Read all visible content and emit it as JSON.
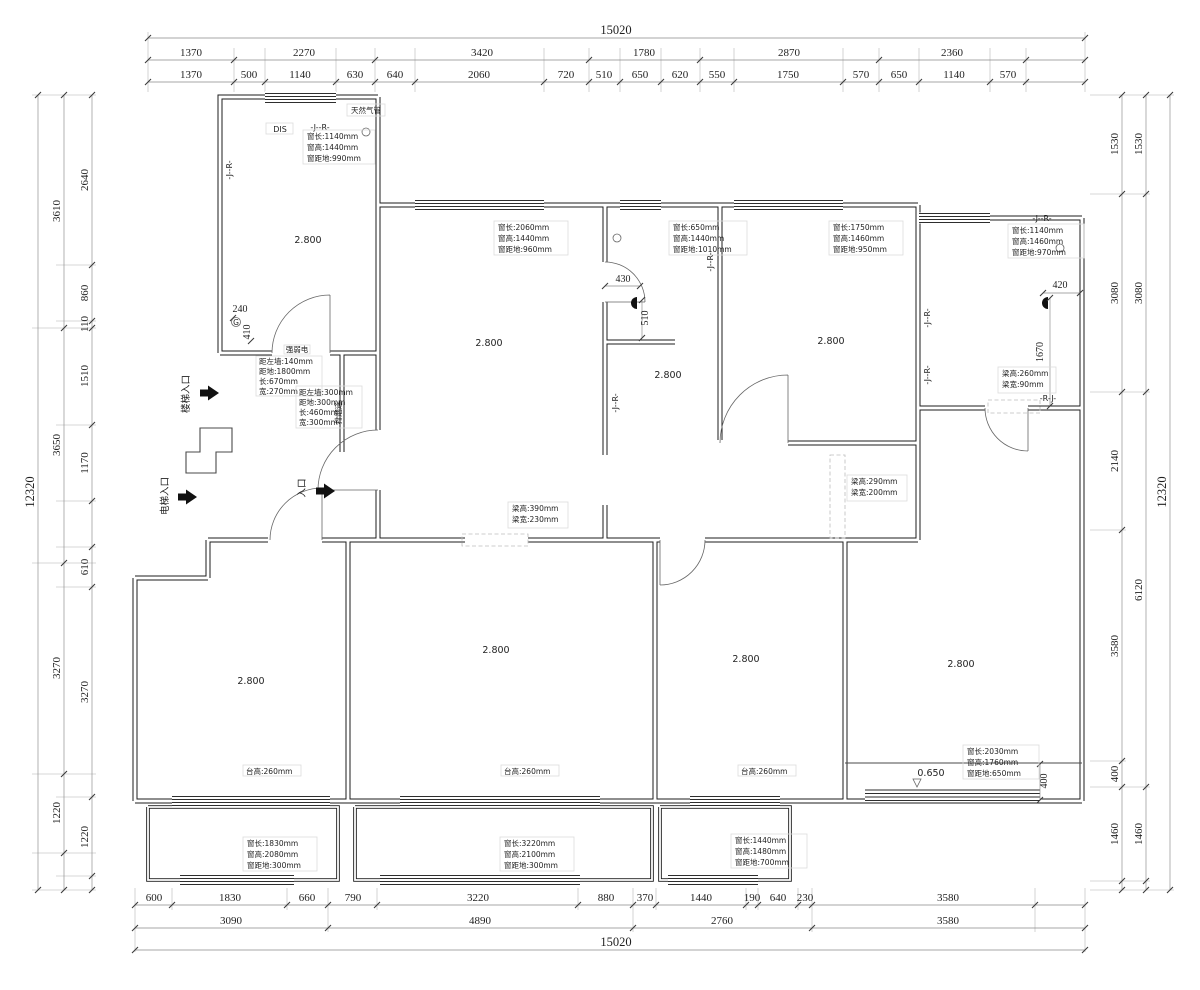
{
  "dims": {
    "top_total": "15020",
    "top_row1": [
      "1370",
      "2270",
      "3420",
      "1780",
      "2870",
      "2360"
    ],
    "top_row2": [
      "1370",
      "500",
      "1140",
      "630",
      "640",
      "2060",
      "720",
      "510",
      "650",
      "620",
      "550",
      "1750",
      "570",
      "650",
      "1140",
      "570"
    ],
    "bottom_row1": [
      "600",
      "1830",
      "660",
      "790",
      "3220",
      "880",
      "370",
      "1440",
      "190",
      "640",
      "230",
      "3580"
    ],
    "bottom_row2": [
      "3090",
      "4890",
      "2760",
      "3580"
    ],
    "bottom_total": "15020",
    "left_total": "12320",
    "left_outer": [
      "3610",
      "3650",
      "3270",
      "1220"
    ],
    "left_inner": [
      "2640",
      "860",
      "110",
      "1510",
      "1170",
      "610",
      "3270",
      "1220"
    ],
    "right_total": "12320",
    "right_outer": [
      "1530",
      "3080",
      "6120",
      "1460"
    ],
    "right_inner": [
      "1530",
      "3080",
      "2140",
      "3580",
      "400",
      "1460"
    ],
    "inline": {
      "d240": "240",
      "d410": "410",
      "d430": "430",
      "d510": "510",
      "d420": "420",
      "d1670": "1670",
      "d400": "400"
    }
  },
  "windows": {
    "tl": {
      "l": "窗长:1140mm",
      "h": "窗高:1440mm",
      "g": "窗距地:990mm"
    },
    "mid": {
      "l": "窗长:2060mm",
      "h": "窗高:1440mm",
      "g": "窗距地:960mm"
    },
    "small": {
      "l": "窗长:650mm",
      "h": "窗高:1440mm",
      "g": "窗距地:1010mm"
    },
    "r3": {
      "l": "窗长:1750mm",
      "h": "窗高:1460mm",
      "g": "窗距地:950mm"
    },
    "tr": {
      "l": "窗长:1140mm",
      "h": "窗高:1460mm",
      "g": "窗距地:970mm"
    },
    "bl": {
      "l": "窗长:1830mm",
      "h": "窗高:2080mm",
      "g": "窗距地:300mm"
    },
    "bm": {
      "l": "窗长:3220mm",
      "h": "窗高:2100mm",
      "g": "窗距地:300mm"
    },
    "brs": {
      "l": "窗长:1440mm",
      "h": "窗高:1480mm",
      "g": "窗距地:700mm"
    },
    "rb": {
      "l": "窗长:2030mm",
      "h": "窗高:1760mm",
      "g": "窗距地:650mm"
    }
  },
  "beams": {
    "b1": {
      "h": "梁高:390mm",
      "w": "梁宽:230mm"
    },
    "b2": {
      "h": "梁高:290mm",
      "w": "梁宽:200mm"
    },
    "b3": {
      "h": "梁高:260mm",
      "w": "梁宽:90mm"
    }
  },
  "boxes": {
    "b1": {
      "title": "强弱电",
      "l1": "距左墙:140mm",
      "l2": "距地:1800mm",
      "l3": "长:670mm",
      "l4": "宽:270mm"
    },
    "b2": {
      "label": "排烟道",
      "l1": "距左墙:300mm",
      "l2": "距地:300mm",
      "l3": "长:460mm",
      "l4": "宽:300mm"
    }
  },
  "labels": {
    "gas": "天然气管",
    "dis": "DIS",
    "jr": "-J--R-",
    "rj": "-R-J-",
    "stair": "楼梯入口",
    "elevator": "电梯入口",
    "entry": "入口",
    "ceiling": "2.800",
    "sill": "台高:260mm",
    "level": "0.650",
    "g": "G"
  }
}
